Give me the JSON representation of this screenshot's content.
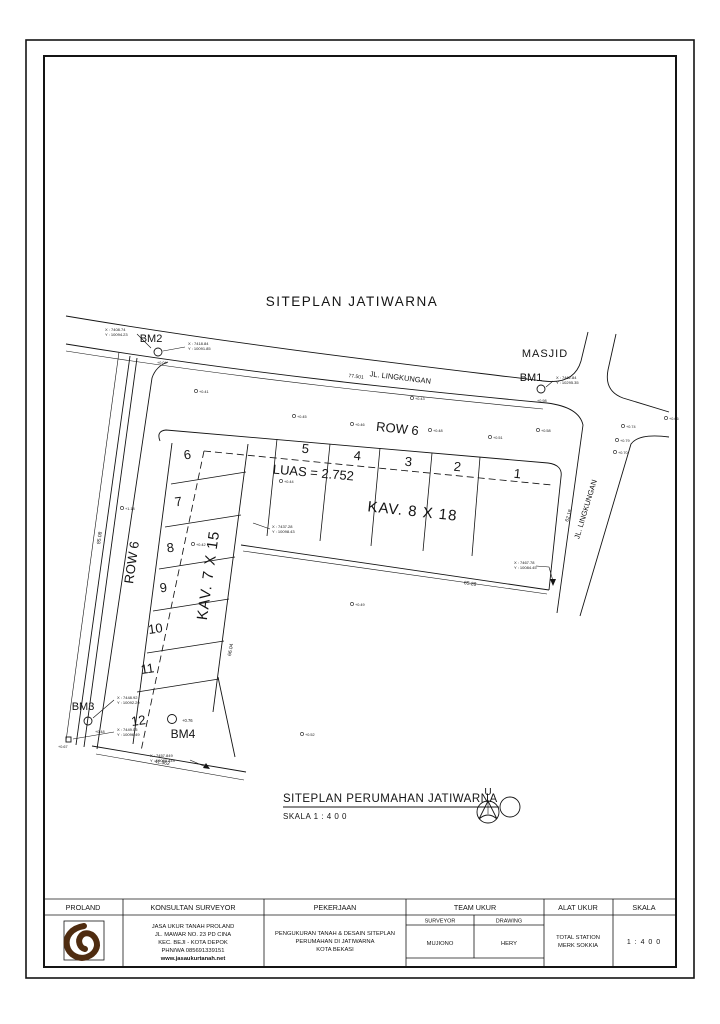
{
  "drawing": {
    "title": "SITEPLAN JATIWARNA",
    "masjid": "MASJID",
    "road_top": "JL. LINGKUNGAN",
    "road_right": "JL. LINGKUNGAN",
    "row_top": "ROW 6",
    "row_left": "ROW 6",
    "luas": "LUAS = 2.752",
    "kav_top": "KAV. 8 X 18",
    "kav_left": "KAV. 7 X 15",
    "plots_top": [
      "5",
      "4",
      "3",
      "2",
      "1"
    ],
    "plots_left": [
      "6",
      "7",
      "8",
      "9",
      "10",
      "11",
      "12"
    ],
    "bm1": {
      "label": "BM1",
      "x": "X : 7462.84",
      "y": "Y : 10295.35",
      "elev": "+0.98"
    },
    "bm2": {
      "label": "BM2",
      "left_x": "X : 7408.74",
      "left_y": "Y : 10094.23",
      "right_x": "X : 7418.84",
      "right_y": "Y : 10091.85",
      "elev": "+0.04"
    },
    "bm3": {
      "label": "BM3",
      "up_x": "X : 7448.92",
      "up_y": "Y : 10092.29",
      "low_x": "X : 7449.05",
      "low_y": "Y : 10096.49",
      "elev": "+0.48",
      "elev2": "+0.67"
    },
    "bm4": {
      "label": "BM4",
      "elev": "+0.76"
    },
    "corner_se": {
      "x": "X : 7467.78",
      "y": "Y : 10084.45"
    },
    "corner_bottom": {
      "x": "X : 7457.849",
      "y": "Y : 10089.449"
    },
    "corner_mid": {
      "x": "X : 7437.28",
      "y": "Y : 10098.43"
    },
    "dims": {
      "road_top": "77.501",
      "road_right": "62.18",
      "left_boundary": "85.08",
      "col_east": "66.04",
      "bottom_arm": "65.28",
      "bottom_12": "41.562"
    },
    "spots": [
      "+0.41",
      "+0.45",
      "+0.46",
      "+0.48",
      "+0.51",
      "+0.43",
      "+0.58",
      "+0.74",
      "+0.79",
      "+0.70",
      "+1.18",
      "+0.42",
      "+0.49",
      "+0.52",
      "+0.66",
      "+0.44"
    ],
    "caption": {
      "title": "SITEPLAN PERUMAHAN JATIWARNA",
      "scale": "SKALA 1 : 4 0 0"
    },
    "north_label": "U"
  },
  "title_block": {
    "proland": {
      "header": "PROLAND"
    },
    "konsultan": {
      "header": "KONSULTAN SURVEYOR",
      "line1": "JASA UKUR TANAH  PROLAND",
      "line2": "JL. MAWAR NO. 23 PD CINA",
      "line3": "KEC. BEJI - KOTA DEPOK",
      "line4": "PHN/WA   085691339151",
      "line5": "www.jasaukurtanah.net"
    },
    "pekerjaan": {
      "header": "PEKERJAAN",
      "line1": "PENGUKURAN TANAH & DESAIN SITEPLAN",
      "line2": "PERUMAHAN DI JATIWARNA",
      "line3": "KOTA BEKASI"
    },
    "team": {
      "header": "TEAM UKUR",
      "surveyor_label": "SURVEYOR",
      "drawing_label": "DRAWING",
      "surveyor_name": "MUJIONO",
      "drawing_name": "HERY"
    },
    "alat": {
      "header": "ALAT UKUR",
      "line1": "TOTAL STATION",
      "line2": "MERK  SOKKIA"
    },
    "skala": {
      "header": "SKALA",
      "value": "1 : 4 0 0"
    }
  },
  "colors": {
    "ink": "#141414",
    "logo_brown": "#4f2c10"
  }
}
